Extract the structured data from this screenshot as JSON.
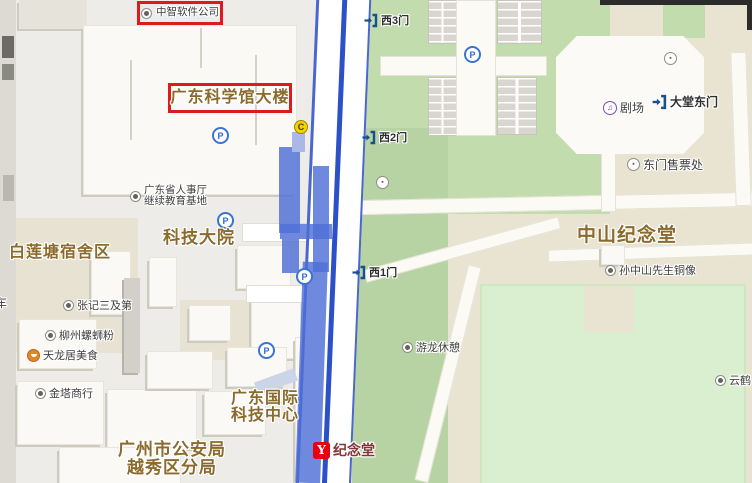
{
  "red_annotations": {
    "company": {
      "label": "中智软件公司"
    },
    "building": {
      "label": "广东科学馆大楼"
    }
  },
  "area_labels": {
    "keji_dayuan": "科技大院",
    "bailiantang": "白莲塘宿舍区",
    "zhongshan_hall": "中山纪念堂",
    "intl_tech_l1": "广东国际",
    "intl_tech_l2": "科技中心",
    "police_l1": "广州市公安局",
    "police_l2": "越秀区分局"
  },
  "pois": {
    "renshiting_l1": "广东省人事厅",
    "renshiting_l2": "继续教育基地",
    "zhangji": "张记三及第",
    "liuzhou": "柳州螺蛳粉",
    "tianlongju": "天龙居美食",
    "jinta": "金塔商行",
    "statue": "孙中山先生铜像",
    "youlong": "游龙休憩",
    "yunhe": "云鹤",
    "juchang": "剧场",
    "ticket_office": "东门售票处"
  },
  "gates": {
    "west3": "西3门",
    "west2": "西2门",
    "west1": "西1门",
    "hall_east": "大堂东门"
  },
  "metro": {
    "name": "纪念堂"
  },
  "edge": {
    "left_char": "车"
  },
  "icons": {
    "parking_letter": "P",
    "camera_letter": "C",
    "music_glyph": "♫",
    "metro_glyph": "Y",
    "misc_glyph": "▪"
  },
  "colors": {
    "annotation_red": "#dd1b1b",
    "route_blue": "#2b50c8",
    "road_casing_blue": "#4a67cf",
    "label_brown": "#8a6b2d",
    "park_green": "#c3dcae",
    "lawn_green": "#d9efcf",
    "tan": "#e8e4d1",
    "metro_red": "#e60012"
  }
}
